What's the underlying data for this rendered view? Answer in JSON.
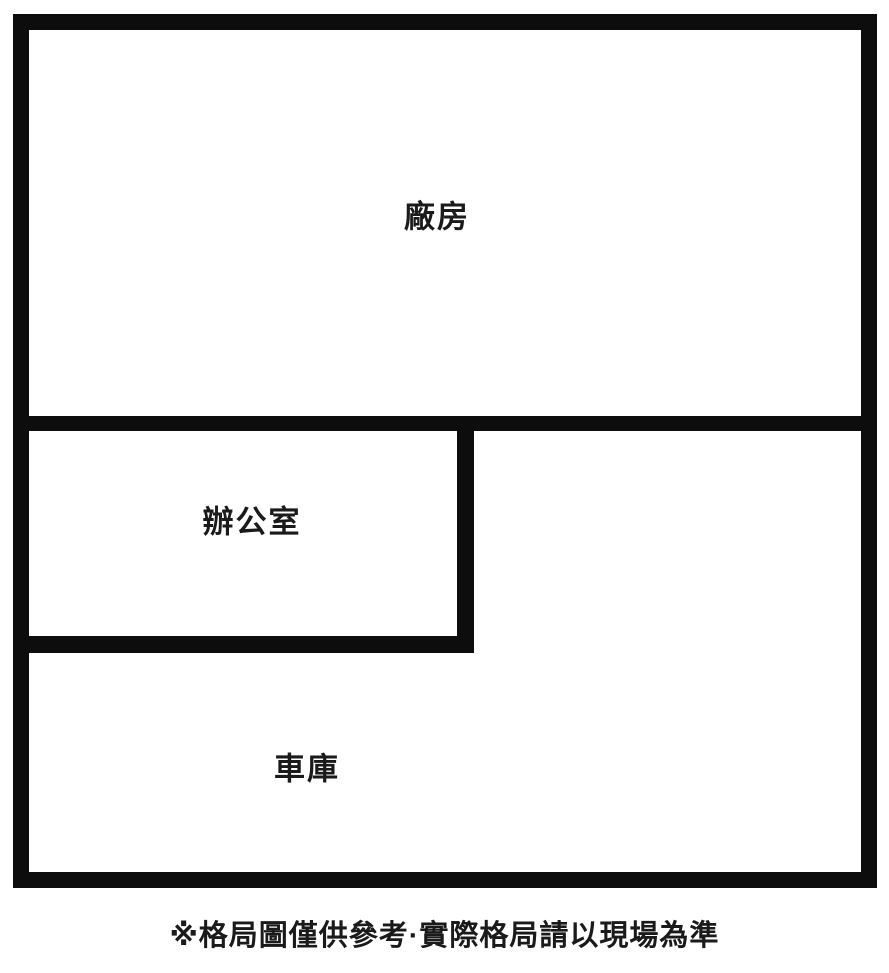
{
  "floor_plan": {
    "title": "格局圖",
    "rooms": [
      {
        "id": "factory",
        "label": "廠房"
      },
      {
        "id": "office",
        "label": "辦公室"
      },
      {
        "id": "garage",
        "label": "車庫"
      }
    ],
    "disclaimer": "※格局圖僅供參考·實際格局請以現場為準",
    "colors": {
      "wall": "#0d0d0d",
      "background": "#ffffff",
      "text": "#1a1a1a"
    }
  }
}
